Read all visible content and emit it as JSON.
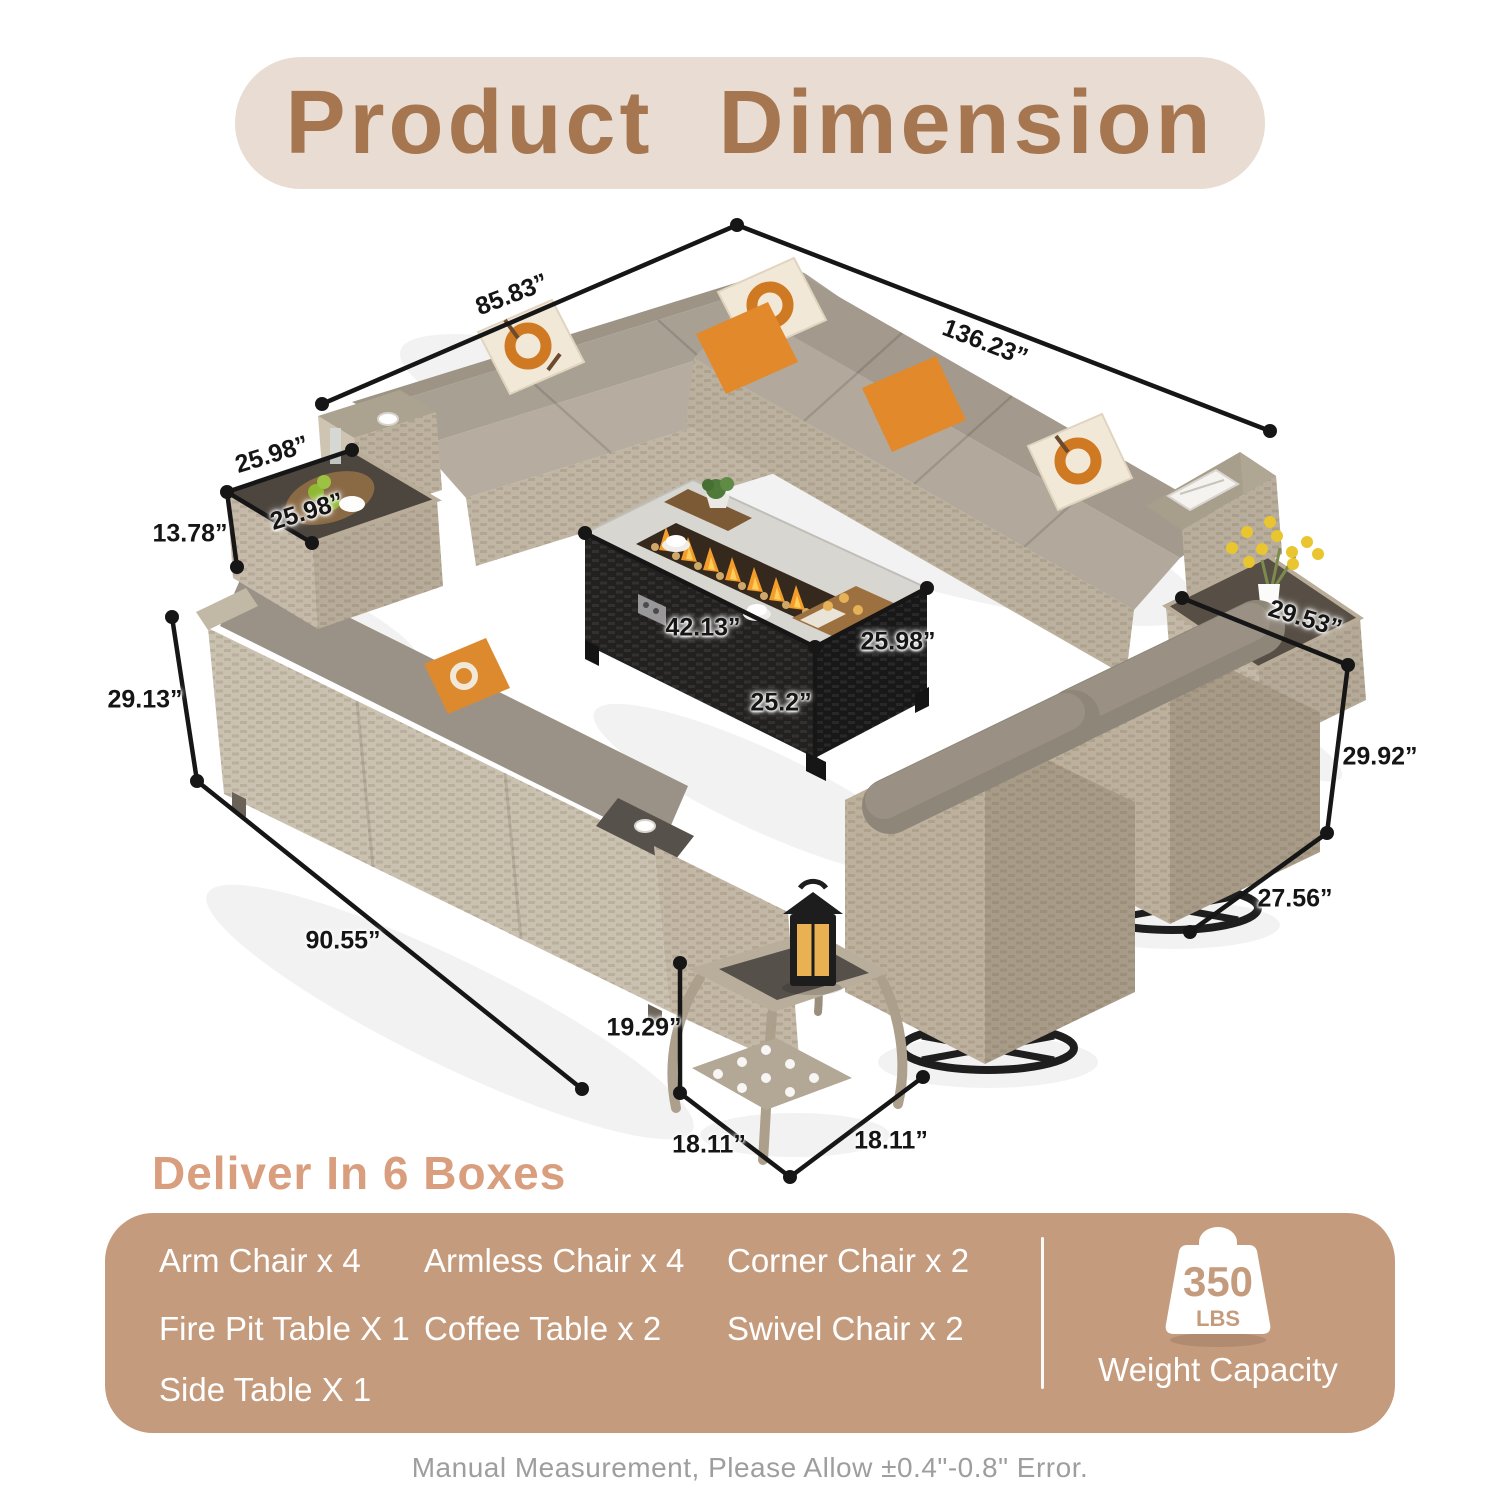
{
  "title": "Product Dimension",
  "deliver_heading": "Deliver In 6 Boxes",
  "footer_note": "Manual Measurement, Please Allow ±0.4\"-0.8\" Error.",
  "dims": {
    "sectional_left_width": "85.83”",
    "sectional_right_width": "136.23”",
    "coffee_table_width": "25.98”",
    "coffee_table_depth": "25.98”",
    "coffee_table_height": "13.78”",
    "sofa_back_height": "29.13”",
    "sofa_length": "90.55”",
    "fire_pit_length": "42.13”",
    "fire_pit_width": "25.98”",
    "fire_pit_height": "25.2”",
    "side_table_flowers_width": "29.53”",
    "swivel_chair_height": "29.92”",
    "swivel_chair_width": "27.56”",
    "lantern_table_height": "19.29”",
    "lantern_table_width": "18.11”",
    "lantern_table_depth": "18.11”"
  },
  "box": {
    "items": [
      "Arm Chair x 4",
      "Armless Chair x 4",
      "Corner Chair x 2",
      "Fire Pit Table X 1",
      "Coffee Table x 2",
      "Swivel Chair x 2",
      "Side Table X 1"
    ],
    "weight_value": "350",
    "weight_unit": "LBS",
    "weight_label": "Weight Capacity"
  },
  "icons": {
    "weight_icon": "kettlebell-weight"
  },
  "colors": {
    "title_text": "#a5764f",
    "title_bg": "#e9dcd2",
    "heading_text": "#d89e7e",
    "box_bg": "#c59b7d",
    "box_text": "#ffffff",
    "footer_text": "#9e9e9e",
    "pillow_orange": "#df8629",
    "dimension_line": "#161616"
  }
}
